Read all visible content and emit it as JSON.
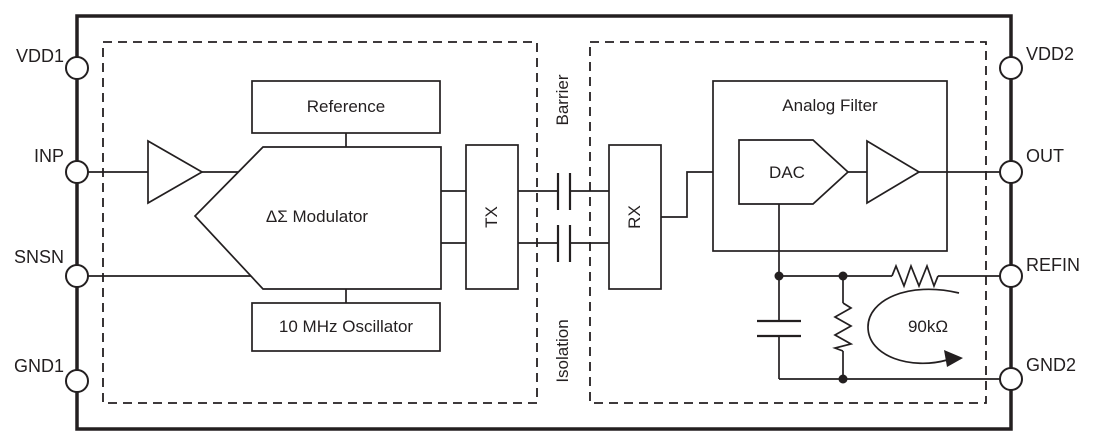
{
  "diagram": {
    "background": "#ffffff",
    "line_color": "#231f20",
    "pins": {
      "left": [
        {
          "label": "VDD1"
        },
        {
          "label": "INP"
        },
        {
          "label": "SNSN"
        },
        {
          "label": "GND1"
        }
      ],
      "right": [
        {
          "label": "VDD2"
        },
        {
          "label": "OUT"
        },
        {
          "label": "REFIN"
        },
        {
          "label": "GND2"
        }
      ]
    },
    "blocks": {
      "reference": "Reference",
      "modulator": "ΔΣ Modulator",
      "oscillator": "10 MHz Oscillator",
      "tx": "TX",
      "rx": "RX",
      "analog_filter": "Analog Filter",
      "dac": "DAC"
    },
    "labels": {
      "barrier": "Barrier",
      "isolation": "Isolation",
      "resistance": "90kΩ"
    }
  }
}
